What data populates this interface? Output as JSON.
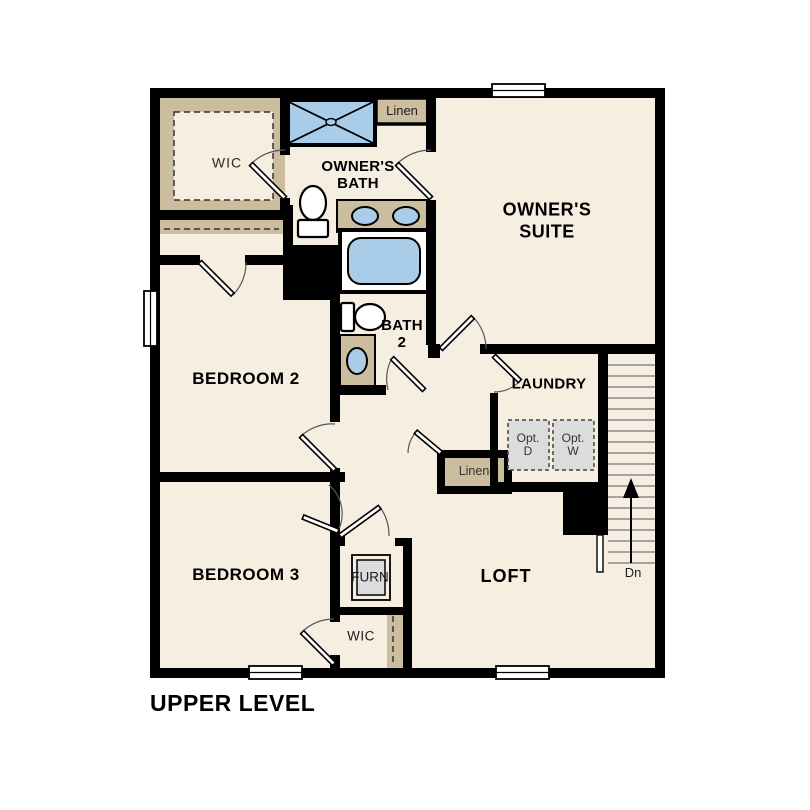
{
  "plan_title": "UPPER LEVEL",
  "colors": {
    "background": "#ffffff",
    "wall": "#000000",
    "floor": "#f6eee0",
    "shelf": "#cbbd9e",
    "fixture_blue": "#a9cce8",
    "appliance_gray": "#dcdcdc",
    "stair_line": "#8a8a8a"
  },
  "labels": {
    "wic_top": "WIC",
    "owners_bath": [
      "OWNER'S",
      "BATH"
    ],
    "linen_top": "Linen",
    "owners_suite": [
      "OWNER'S",
      "SUITE"
    ],
    "bedroom2": "BEDROOM 2",
    "bath2": [
      "BATH",
      "2"
    ],
    "laundry": "LAUNDRY",
    "opt_dryer": [
      "Opt.",
      "D"
    ],
    "opt_washer": [
      "Opt.",
      "W"
    ],
    "linen_bottom": "Linen",
    "bedroom3": "BEDROOM 3",
    "furnace": "FURN",
    "loft": "LOFT",
    "wic_bottom": "WIC",
    "stairs_down": "Dn"
  }
}
